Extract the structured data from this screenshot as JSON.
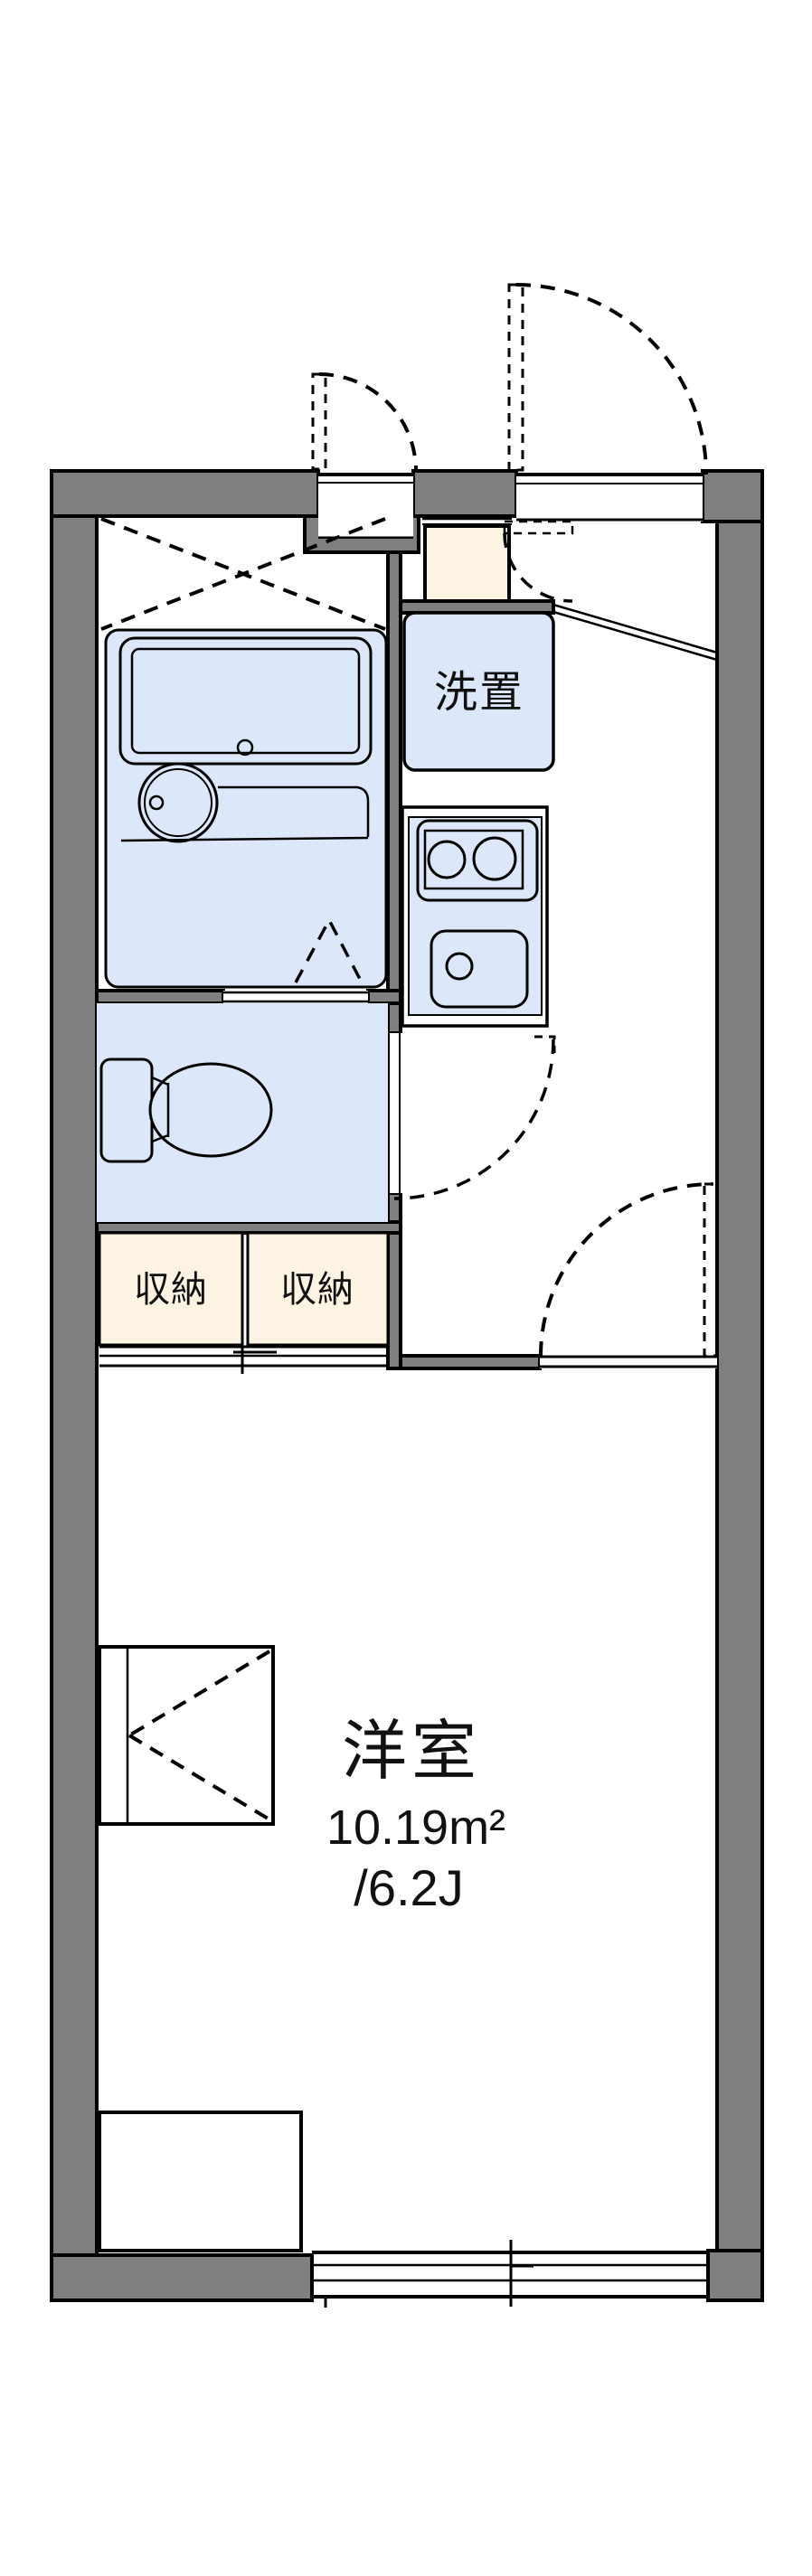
{
  "floor_plan": {
    "labels": {
      "washer_storage": "洗置",
      "storage_left": "収納",
      "storage_right": "収納",
      "main_room": "洋室",
      "main_room_area_sqm": "10.19m²",
      "main_room_area_tatami": "/6.2J"
    },
    "colors": {
      "wall_fill": "#7f7f7f",
      "outline": "#000000",
      "fixture_fill": "#dce8f9",
      "storage_fill": "#fcf3e2",
      "floor_fill": "#ffffff",
      "text": "#111111"
    }
  }
}
